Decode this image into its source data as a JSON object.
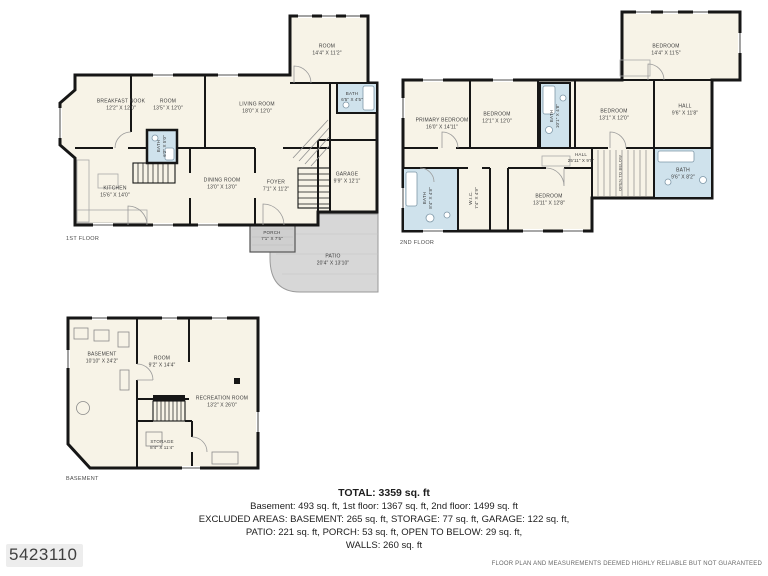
{
  "colors": {
    "background": "#ffffff",
    "wall": "#161616",
    "room_fill": "#f7f3e7",
    "bath_fill": "#cfe2ec",
    "outdoor_fill": "#d7d7d7",
    "label_text": "#3c3c3c"
  },
  "floors": {
    "first": {
      "label": "1ST FLOOR",
      "rooms": {
        "breakfast_nook": {
          "name": "BREAKFAST NOOK",
          "dims": "12'2\" X 12'0\""
        },
        "room": {
          "name": "ROOM",
          "dims": "13'5\" X 12'0\""
        },
        "living_room": {
          "name": "LIVING ROOM",
          "dims": "18'0\" X 12'0\""
        },
        "upper_room": {
          "name": "ROOM",
          "dims": "14'4\" X 11'2\""
        },
        "bath_top": {
          "name": "BATH",
          "dims": "6'5\" X 4'5\""
        },
        "bath_small": {
          "name": "BATH",
          "dims": "6'2\" X 5'0\""
        },
        "kitchen": {
          "name": "KITCHEN",
          "dims": "15'6\" X 14'0\""
        },
        "dining_room": {
          "name": "DINING ROOM",
          "dims": "13'0\" X 13'0\""
        },
        "foyer": {
          "name": "FOYER",
          "dims": "7'1\" X 11'2\""
        },
        "garage": {
          "name": "GARAGE",
          "dims": "9'9\" X 12'1\""
        },
        "porch": {
          "name": "PORCH",
          "dims": "7'1\" X 7'5\""
        },
        "patio": {
          "name": "PATIO",
          "dims": "20'4\" X 13'10\""
        }
      }
    },
    "second": {
      "label": "2ND FLOOR",
      "rooms": {
        "primary_bedroom": {
          "name": "PRIMARY BEDROOM",
          "dims": "16'0\" X 14'11\""
        },
        "bedroom_2": {
          "name": "BEDROOM",
          "dims": "12'1\" X 12'0\""
        },
        "bath_center": {
          "name": "BATH",
          "dims": "10'1\" X 4'8\""
        },
        "bedroom_3": {
          "name": "BEDROOM",
          "dims": "13'1\" X 12'0\""
        },
        "bedroom_4": {
          "name": "BEDROOM",
          "dims": "14'4\" X 11'5\""
        },
        "hall_right": {
          "name": "HALL",
          "dims": "9'6\" X 11'8\""
        },
        "bath_right": {
          "name": "BATH",
          "dims": "9'6\" X 8'2\""
        },
        "hall_main": {
          "name": "HALL",
          "dims": "25'11\" X 9'5\""
        },
        "bath_left": {
          "name": "BATH",
          "dims": "8'4\" X 4'8\""
        },
        "wic": {
          "name": "W.I.C.",
          "dims": "7'4\" X 4'9\""
        },
        "bedroom_5": {
          "name": "BEDROOM",
          "dims": "13'11\" X 12'8\""
        },
        "open_to_below": {
          "name": "OPEN TO BELOW",
          "dims": ""
        }
      }
    },
    "basement": {
      "label": "BASEMENT",
      "rooms": {
        "basement_area": {
          "name": "BASEMENT",
          "dims": "10'10\" X 24'2\""
        },
        "room": {
          "name": "ROOM",
          "dims": "9'2\" X 14'4\""
        },
        "recreation_room": {
          "name": "RECREATION ROOM",
          "dims": "13'2\" X 26'0\""
        },
        "storage": {
          "name": "STORAGE",
          "dims": "8'4\" X 11'4\""
        }
      }
    }
  },
  "summary": {
    "total": "TOTAL: 3359 sq. ft",
    "line_floors": "Basement: 493 sq. ft, 1st floor: 1367 sq. ft, 2nd floor: 1499 sq. ft",
    "line_excluded_1": "EXCLUDED AREAS: BASEMENT: 265 sq. ft, STORAGE: 77 sq. ft, GARAGE: 122 sq. ft,",
    "line_excluded_2": "PATIO: 221 sq. ft, PORCH: 53 sq. ft, OPEN TO BELOW: 29 sq. ft,",
    "line_walls": "WALLS: 260 sq. ft"
  },
  "footer": {
    "listing_id": "5423110",
    "disclaimer": "FLOOR PLAN AND MEASUREMENTS DEEMED HIGHLY RELIABLE BUT NOT GUARANTEED"
  }
}
